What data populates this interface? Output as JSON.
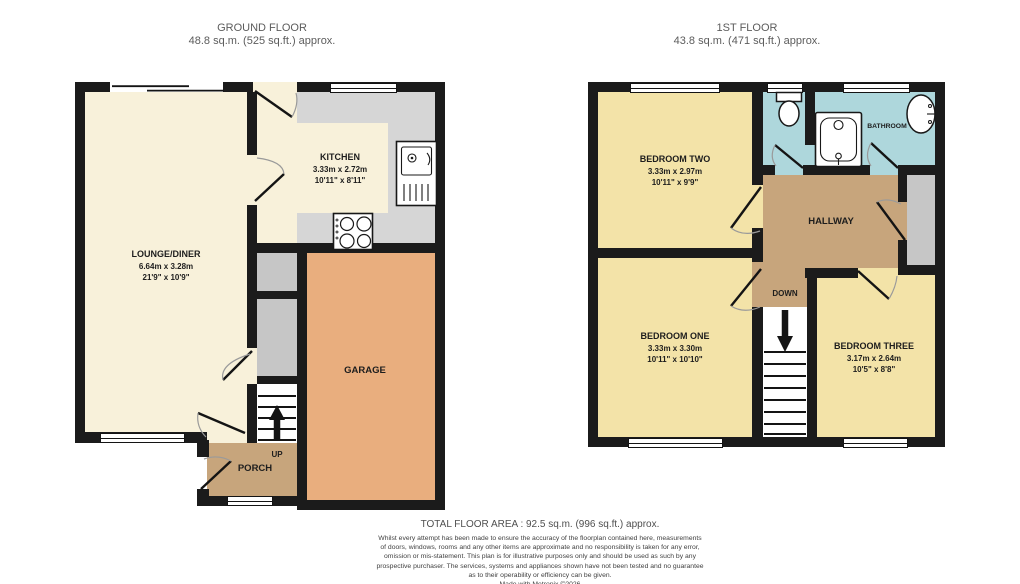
{
  "ground_floor": {
    "title": "GROUND FLOOR",
    "area": "48.8 sq.m. (525 sq.ft.) approx.",
    "stairs_label": "UP",
    "rooms": {
      "lounge": {
        "name": "LOUNGE/DINER",
        "metric": "6.64m x 3.28m",
        "imperial": "21'9\" x 10'9\""
      },
      "kitchen": {
        "name": "KITCHEN",
        "metric": "3.33m x 2.72m",
        "imperial": "10'11\" x 8'11\""
      },
      "garage": {
        "name": "GARAGE"
      },
      "porch": {
        "name": "PORCH"
      }
    }
  },
  "first_floor": {
    "title": "1ST FLOOR",
    "area": "43.8 sq.m. (471 sq.ft.) approx.",
    "stairs_label": "DOWN",
    "rooms": {
      "bedroom_two": {
        "name": "BEDROOM TWO",
        "metric": "3.33m x 2.97m",
        "imperial": "10'11\" x 9'9\""
      },
      "bedroom_one": {
        "name": "BEDROOM ONE",
        "metric": "3.33m x 3.30m",
        "imperial": "10'11\" x 10'10\""
      },
      "bedroom_three": {
        "name": "BEDROOM THREE",
        "metric": "3.17m x 2.64m",
        "imperial": "10'5\" x 8'8\""
      },
      "bathroom": {
        "name": "BATHROOM"
      },
      "hallway": {
        "name": "HALLWAY"
      }
    }
  },
  "footer": {
    "total_area": "TOTAL FLOOR AREA : 92.5 sq.m. (996 sq.ft.) approx.",
    "disclaimer_lines": [
      "Whilst every attempt has been made to ensure the accuracy of the floorplan contained here, measurements",
      "of doors, windows, rooms and any other items are approximate and no responsibility is taken for any error,",
      "omission or mis-statement. This plan is for illustrative purposes only and should be used as such by any",
      "prospective purchaser. The services, systems and appliances shown have not been tested and no guarantee",
      "as to their operability or efficiency can be given."
    ],
    "credit": "Made with Metropix ©2026"
  },
  "colors": {
    "wall": "#1b1b1b",
    "floor_cream": "#f8f1da",
    "floor_yellow": "#f3e3a8",
    "floor_garage": "#e9ae7e",
    "floor_tan": "#c7a57c",
    "floor_blue": "#aed7dc",
    "counter_gray": "#d6d6d6",
    "cupboard_gray": "#c6c6c6",
    "title_text": "#5c5c5c",
    "label_text": "#1d1d1d"
  }
}
